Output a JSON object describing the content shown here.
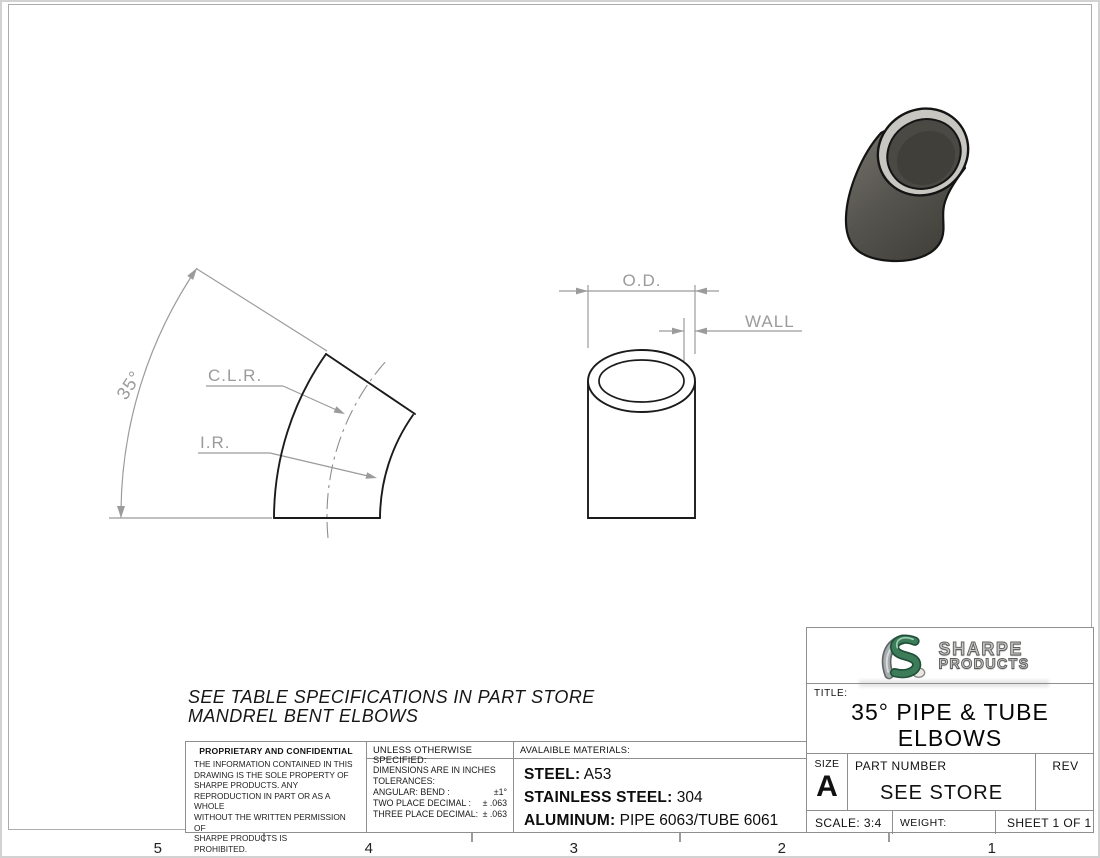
{
  "drawing": {
    "left_view": {
      "angle_label": "35°",
      "clr_label": "C.L.R.",
      "ir_label": "I.R."
    },
    "front_view": {
      "od_label": "O.D.",
      "wall_label": "WALL"
    },
    "note_line1": "SEE TABLE SPECIFICATIONS IN PART STORE",
    "note_line2": "MANDREL BENT ELBOWS"
  },
  "zones": [
    "5",
    "4",
    "3",
    "2",
    "1"
  ],
  "proprietary": {
    "title": "PROPRIETARY AND CONFIDENTIAL",
    "body": "THE INFORMATION CONTAINED IN THIS\nDRAWING IS THE SOLE PROPERTY OF\nSHARPE PRODUCTS.  ANY\nREPRODUCTION IN PART OR AS A WHOLE\nWITHOUT THE WRITTEN PERMISSION OF\nSHARPE PRODUCTS IS\nPROHIBITED."
  },
  "tolerances": {
    "header": "UNLESS OTHERWISE SPECIFIED:",
    "line1": "DIMENSIONS ARE IN INCHES",
    "line2": "TOLERANCES:",
    "angular_label": "ANGULAR: BEND :",
    "angular_value": "±1°",
    "two_place_label": "TWO PLACE DECIMAL  :",
    "two_place_value": "± .063",
    "three_place_label": "THREE PLACE DECIMAL:",
    "three_place_value": "± .063"
  },
  "materials": {
    "header": "AVALAIBLE MATERIALS:",
    "rows": [
      {
        "label": "STEEL:",
        "value": "A53"
      },
      {
        "label": "STAINLESS STEEL:",
        "value": "304"
      },
      {
        "label": "ALUMINUM:",
        "value": "PIPE 6063/TUBE 6061"
      }
    ]
  },
  "title_block": {
    "brand_line1": "SHARPE",
    "brand_line2": "PRODUCTS",
    "title_label": "TITLE:",
    "title_line1": "35° PIPE & TUBE",
    "title_line2": "ELBOWS",
    "size_label": "SIZE",
    "size_value": "A",
    "part_number_label": "PART NUMBER",
    "part_number_value": "SEE STORE",
    "rev_label": "REV",
    "scale": "SCALE: 3:4",
    "weight": "WEIGHT:",
    "sheet": "SHEET 1 OF 1"
  },
  "colors": {
    "part_outline": "#1b1b1b",
    "dimension_gray": "#9b9b9b",
    "render_body": "#55534d",
    "render_rim": "#c8c6c0",
    "logo_green": "#3d7c59",
    "logo_silver": "#a7acae"
  }
}
